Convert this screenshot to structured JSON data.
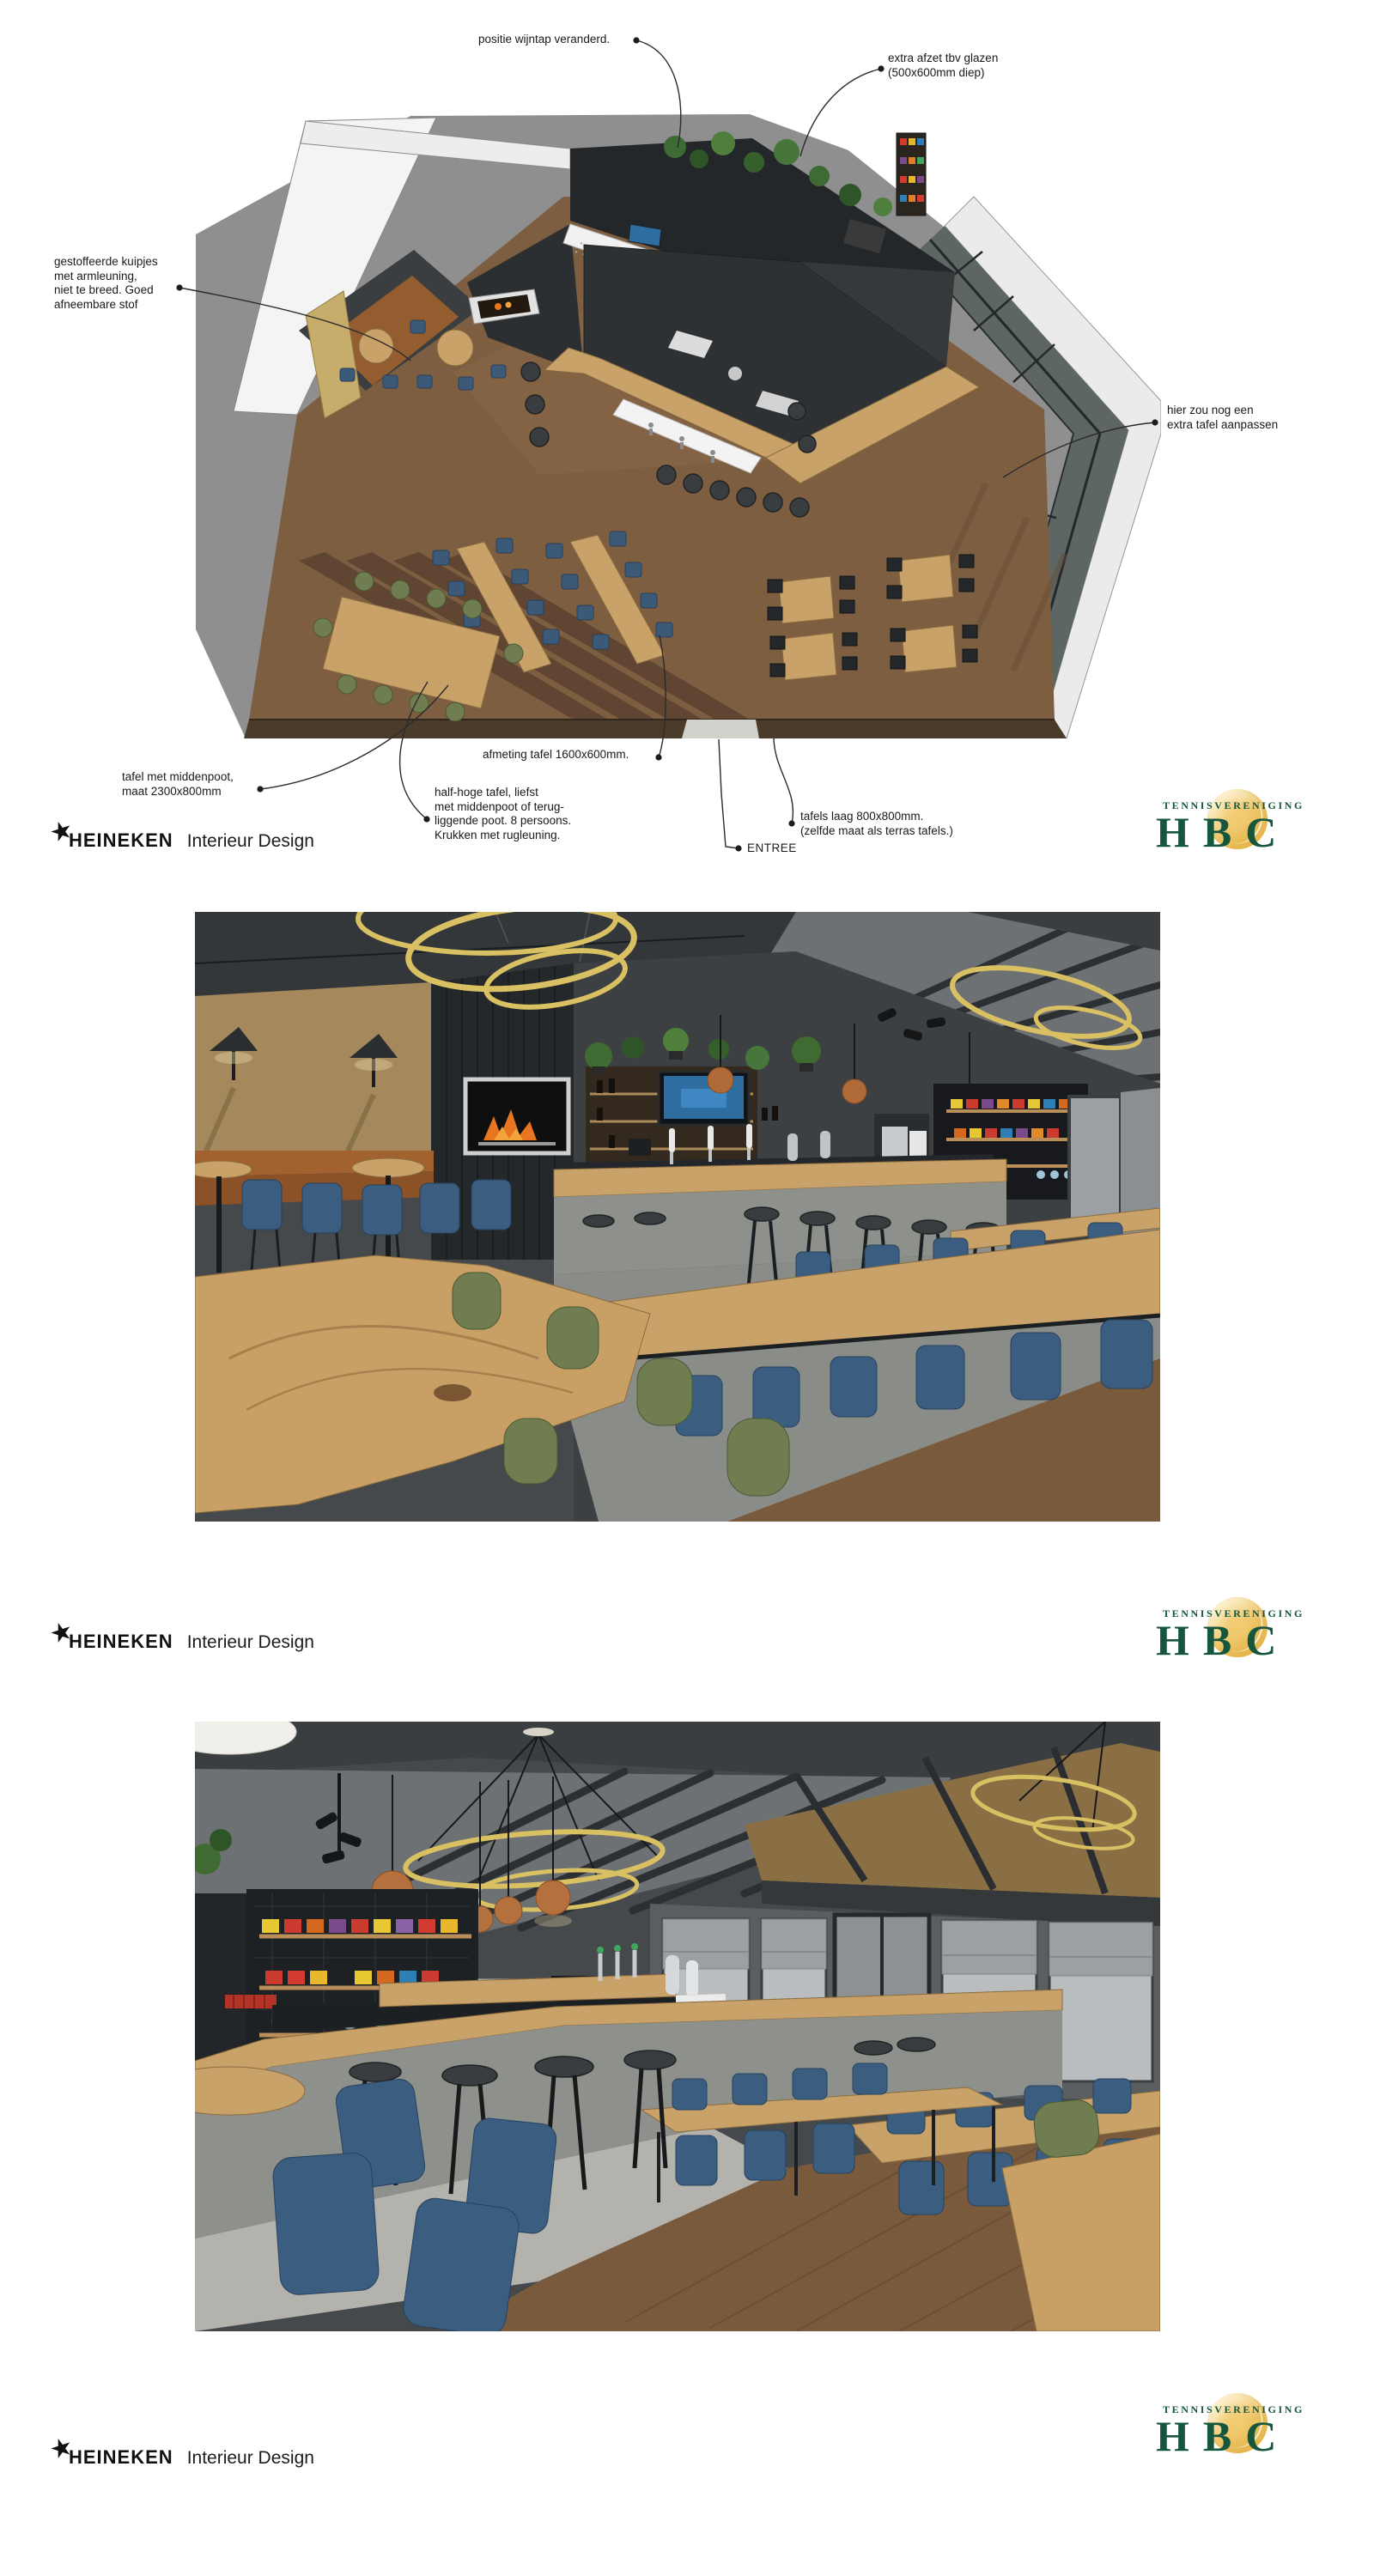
{
  "branding": {
    "heineken": {
      "star": "★",
      "name": "HEINEKEN",
      "suffix": "Interieur Design"
    },
    "hbc": {
      "association": "TENNISVERENIGING",
      "name": "HBC",
      "green": "#15563c",
      "ball_color": "#f1cb72"
    }
  },
  "colors": {
    "page_background": "#ffffff",
    "annotation_text": "#191919",
    "leader_line": "#2b2b2b",
    "wood": "#c9a26a",
    "chair_blue": "#3b5d80",
    "chair_green": "#6f7d50",
    "ring_gold": "#d9c063"
  },
  "floorplan": {
    "annotations": [
      {
        "id": "wijntap",
        "text": "positie wijntap veranderd."
      },
      {
        "id": "afzet",
        "text": "extra afzet tbv glazen\n(500x600mm diep)"
      },
      {
        "id": "kuipjes",
        "text": "gestoffeerde kuipjes\nmet armleuning,\nniet te breed. Goed\nafneembare stof"
      },
      {
        "id": "extra-tafel",
        "text": "hier zou nog een\nextra tafel aanpassen"
      },
      {
        "id": "middenpoot",
        "text": "tafel met middenpoot,\nmaat 2300x800mm"
      },
      {
        "id": "afmeting",
        "text": "afmeting tafel 1600x600mm."
      },
      {
        "id": "half-hoge",
        "text": "half-hoge tafel, liefst\nmet middenpoot of terug-\nliggende poot. 8 persoons.\nKrukken met rugleuning."
      },
      {
        "id": "tafels-laag",
        "text": "tafels laag 800x800mm.\n(zelfde maat als terras tafels.)"
      },
      {
        "id": "entree",
        "text": "ENTREE"
      }
    ]
  }
}
